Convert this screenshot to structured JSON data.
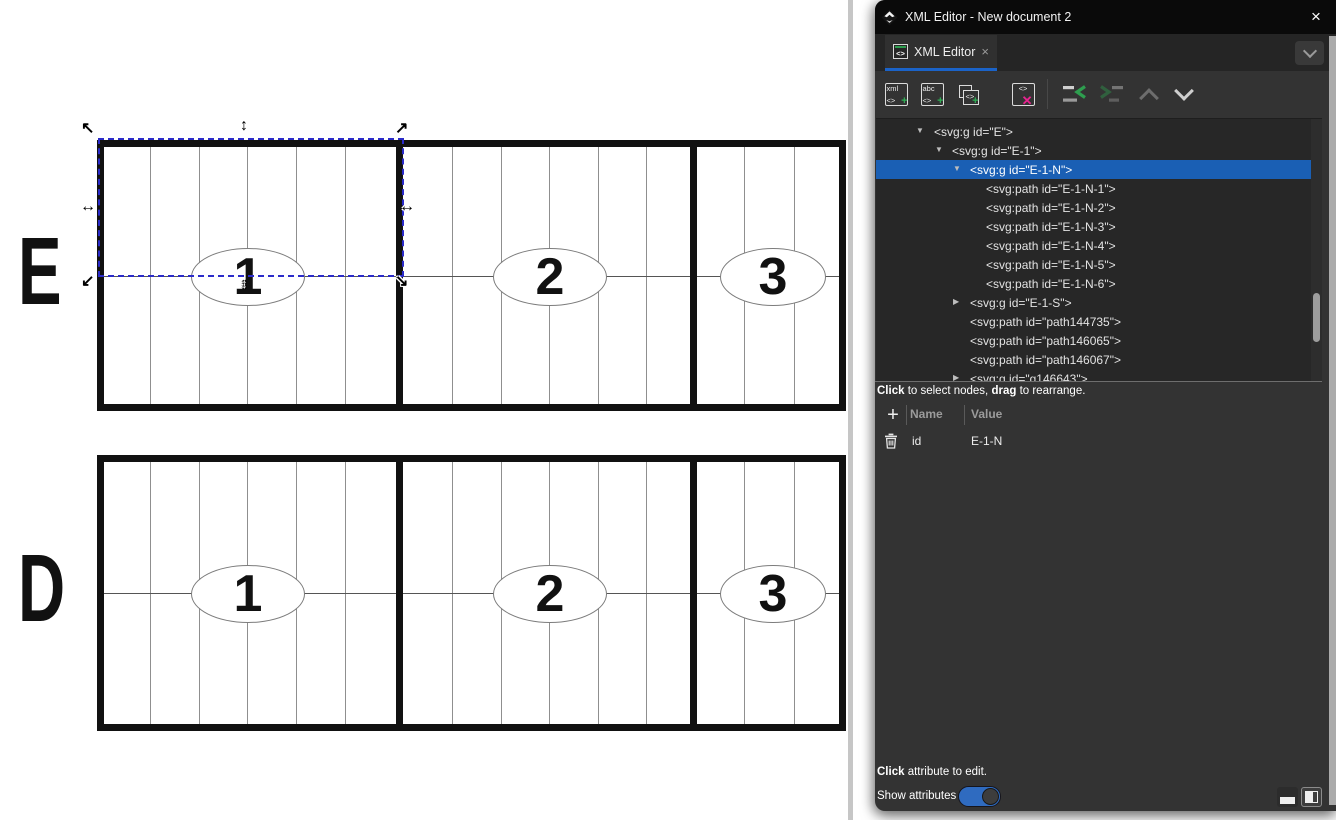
{
  "window": {
    "title": "XML Editor - New document 2",
    "close": "×"
  },
  "tab": {
    "label": "XML Editor",
    "close": "×",
    "icon_glyph": "<>"
  },
  "toolbar": {
    "new_element_label": "xml",
    "new_text_label": "abc",
    "code_glyph": "<>",
    "plus_glyph": "+",
    "delete_glyph": "✕"
  },
  "tree": {
    "items": [
      {
        "text": "<svg:g id=\"E\">",
        "depth": 0,
        "expander": "open",
        "selected": false
      },
      {
        "text": "<svg:g id=\"E-1\">",
        "depth": 1,
        "expander": "open",
        "selected": false
      },
      {
        "text": "<svg:g id=\"E-1-N\">",
        "depth": 2,
        "expander": "open",
        "selected": true
      },
      {
        "text": "<svg:path id=\"E-1-N-1\">",
        "depth": 3,
        "expander": null,
        "selected": false
      },
      {
        "text": "<svg:path id=\"E-1-N-2\">",
        "depth": 3,
        "expander": null,
        "selected": false
      },
      {
        "text": "<svg:path id=\"E-1-N-3\">",
        "depth": 3,
        "expander": null,
        "selected": false
      },
      {
        "text": "<svg:path id=\"E-1-N-4\">",
        "depth": 3,
        "expander": null,
        "selected": false
      },
      {
        "text": "<svg:path id=\"E-1-N-5\">",
        "depth": 3,
        "expander": null,
        "selected": false
      },
      {
        "text": "<svg:path id=\"E-1-N-6\">",
        "depth": 3,
        "expander": null,
        "selected": false
      },
      {
        "text": "<svg:g id=\"E-1-S\">",
        "depth": 2,
        "expander": "closed",
        "selected": false
      },
      {
        "text": "<svg:path id=\"path144735\">",
        "depth": 2,
        "expander": null,
        "selected": false
      },
      {
        "text": "<svg:path id=\"path146065\">",
        "depth": 2,
        "expander": null,
        "selected": false
      },
      {
        "text": "<svg:path id=\"path146067\">",
        "depth": 2,
        "expander": null,
        "selected": false
      },
      {
        "text": "<svg:g id=\"g146643\">",
        "depth": 2,
        "expander": "closed",
        "selected": false
      }
    ],
    "hint_bold1": "Click",
    "hint_mid": " to select nodes, ",
    "hint_bold2": "drag",
    "hint_end": " to rearrange."
  },
  "attributes": {
    "name_header": "Name",
    "value_header": "Value",
    "rows": [
      {
        "name": "id",
        "value": "E-1-N"
      }
    ]
  },
  "footer": {
    "edit_hint_bold": "Click",
    "edit_hint_rest": " attribute to edit.",
    "show_attributes": "Show attributes",
    "toggle_on": true
  },
  "canvas": {
    "structures": [
      {
        "label": "E",
        "sections": [
          "1",
          "2",
          "3"
        ]
      },
      {
        "label": "D",
        "sections": [
          "1",
          "2",
          "3"
        ]
      }
    ],
    "selection": {
      "selected_node_id": "E-1-N"
    },
    "colors": {
      "selection_blue": "#2b2bc9",
      "accent_blue": "#1a5fb4",
      "tab_underline": "#1b63c8"
    }
  }
}
